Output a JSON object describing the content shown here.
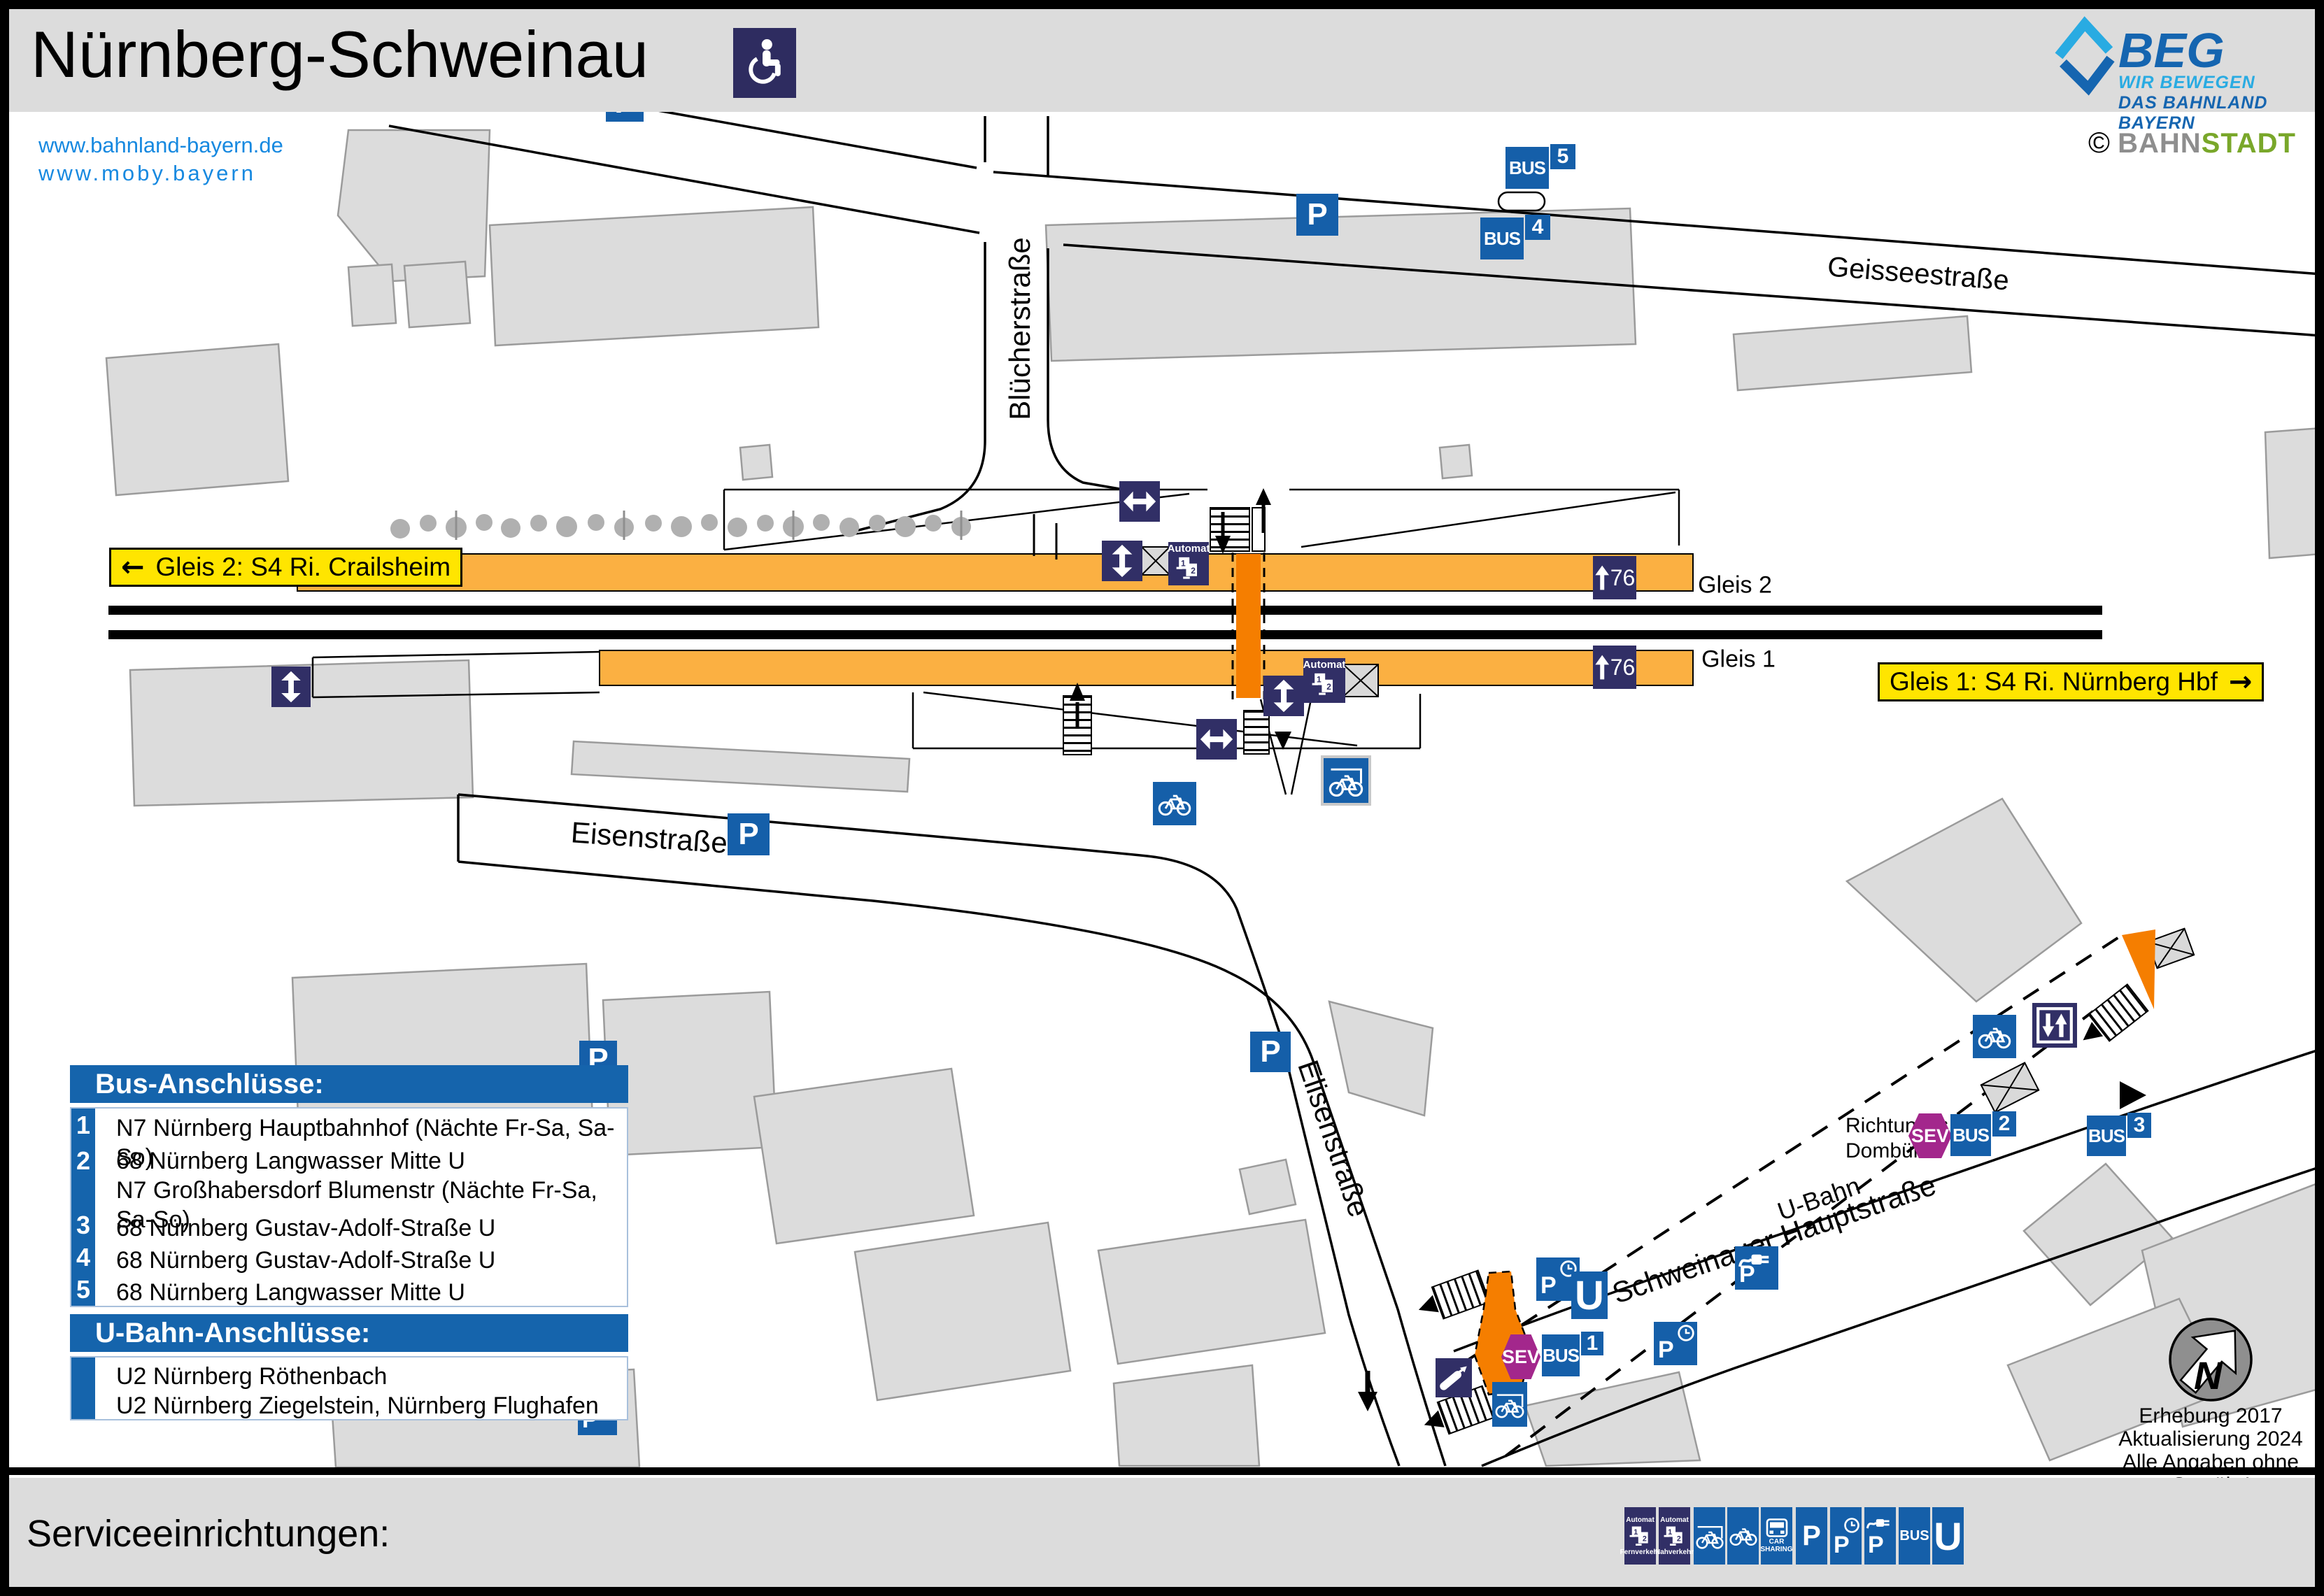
{
  "header": {
    "title": "Nürnberg-Schweinau",
    "link1": "www.bahnland-bayern.de",
    "link2": "www.moby.bayern",
    "beg_name": "BEG",
    "beg_tagline1": "WIR BEWEGEN",
    "beg_tagline2": "DAS BAHNLAND BAYERN",
    "credit_symbol": "©",
    "credit_part1": "BAHN",
    "credit_part2": "STADT"
  },
  "map": {
    "streets": {
      "bluecherstrasse": "Blücherstraße",
      "geisseestrasse": "Geisseestraße",
      "eisenstrasse": "Eisenstraße",
      "elisenstrasse": "Elisenstraße",
      "schweinauer_hauptstrasse": "Schweinauer  Hauptstraße",
      "u_bahn": "U-Bahn"
    },
    "signs": {
      "gleis2_direction": "Gleis 2: S4 Ri. Crailsheim",
      "gleis1_direction": "Gleis 1: S4 Ri. Nürnberg Hbf",
      "arrow_left": "←",
      "arrow_right": "→",
      "gleis2": "Gleis 2",
      "gleis1": "Gleis 1",
      "platform_height": "76",
      "richtung_line1": "Richtung",
      "richtung_line2": "Dombühl"
    },
    "badges": {
      "p": "P",
      "bus": "BUS",
      "u": "U",
      "sev": "SEV",
      "automat": "Automat",
      "north": "N",
      "machine_1": "1",
      "machine_2": "2",
      "car_line1": "CAR",
      "car_line2": "SHARING"
    },
    "bus_stop_numbers": {
      "b1": "1",
      "b2": "2",
      "b3": "3",
      "b4": "4",
      "b5": "5"
    },
    "notes": {
      "line1": "Erhebung 2017",
      "line2": "Aktualisierung 2024",
      "line3": "Alle Angaben ohne Gewähr!"
    }
  },
  "legend_bus": {
    "title": "Bus-Anschlüsse:",
    "rows": [
      {
        "num": "1",
        "line1": "N7 Nürnberg Hauptbahnhof (Nächte Fr-Sa, Sa-So)"
      },
      {
        "num": "2",
        "line1": "68 Nürnberg Langwasser Mitte U",
        "line2": "N7 Großhabersdorf Blumenstr (Nächte Fr-Sa, Sa-So)"
      },
      {
        "num": "3",
        "line1": "68 Nürnberg Gustav-Adolf-Straße U"
      },
      {
        "num": "4",
        "line1": "68 Nürnberg Gustav-Adolf-Straße U"
      },
      {
        "num": "5",
        "line1": "68 Nürnberg Langwasser Mitte U"
      }
    ]
  },
  "legend_ubahn": {
    "title": "U-Bahn-Anschlüsse:",
    "row1": "U2 Nürnberg Röthenbach",
    "row2": "U2 Nürnberg Ziegelstein, Nürnberg Flughafen"
  },
  "services": {
    "title": "Serviceeinrichtungen:",
    "automat_label": "Automat",
    "automat1_sub": "Fernverkehr",
    "automat2_sub": "Nahverkehr"
  },
  "colors": {
    "accent_blue": "#155FA9",
    "navy": "#312F66",
    "beg_light_blue": "#29ABE2",
    "beg_dark_blue": "#1565B0",
    "link_blue": "#1789E0",
    "platform_orange": "#FBB042",
    "crossing_orange": "#F57E00",
    "sign_yellow": "#FFE500",
    "sev_purple": "#A3278C",
    "stadt_green": "#79A72A",
    "building_gray": "#DCDCDC",
    "bar_gray": "#DCDCDC"
  }
}
